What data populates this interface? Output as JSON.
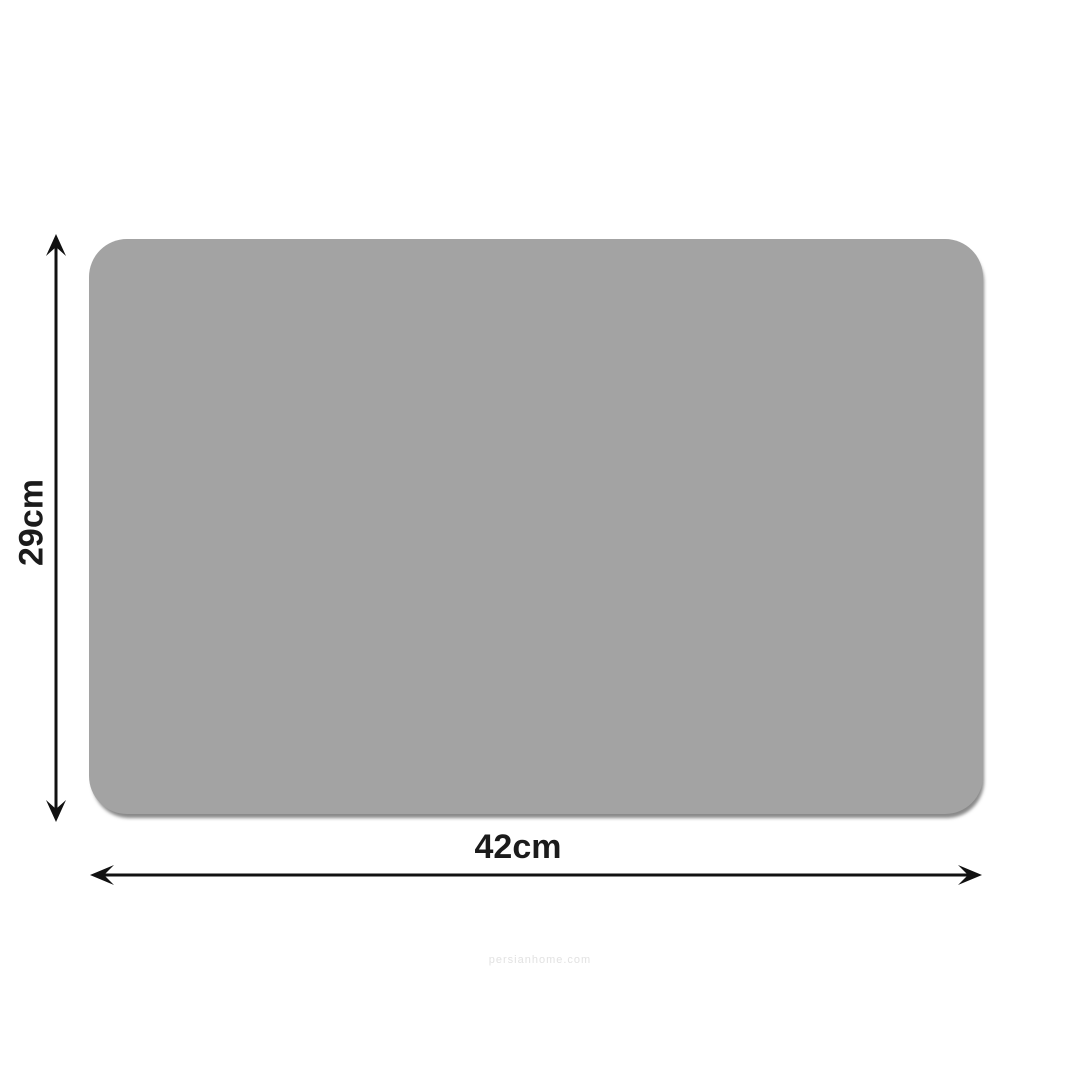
{
  "diagram": {
    "type": "product-dimension-diagram",
    "product": "rectangular mat with rounded corners",
    "height_label": "29cm",
    "width_label": "42cm",
    "watermark": "persianhome.com",
    "colors": {
      "background": "#ffffff",
      "mat_fill": "#a3a3a3",
      "mat_shadow": "#6e6e6e",
      "dimension_lines": "#111111",
      "label_text": "#1b1b1b",
      "watermark_text": "#e2e2e2"
    }
  }
}
